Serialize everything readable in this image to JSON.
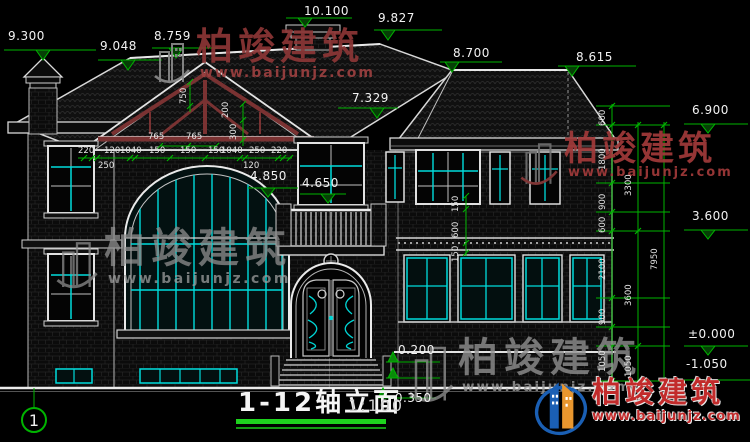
{
  "drawing": {
    "title": "1-12轴立面",
    "scale": "1:100",
    "axis_label": "1",
    "watermark": {
      "brand": "柏竣建筑",
      "url": "www.baijunjz.com"
    },
    "elevations": {
      "chimney_left": "9.300",
      "roof_left": "9.048",
      "gable_peak": "8.759",
      "roof_chimney_top": "10.100",
      "ridge": "9.827",
      "deck_left": "8.700",
      "deck_right": "8.615",
      "eave_right": "7.329",
      "level_eave": "6.900",
      "gable_window_head": "4.850",
      "balcony_rail": "4.650",
      "level_floor2": "3.600",
      "level_zero": "±0.000",
      "level_foundation": "-1.050",
      "entry_landing": "0.200",
      "entry_ground": "-0.350"
    },
    "dims": {
      "gable_width_row": [
        "765",
        "765"
      ],
      "facade_row": [
        "220",
        "120",
        "1040",
        "150",
        "150",
        "150",
        "1040",
        "250",
        "220"
      ],
      "facade_row2": [
        "250",
        "120"
      ],
      "truss": [
        "750",
        "200",
        "300"
      ],
      "cornice": [
        "150",
        "600",
        "150"
      ],
      "right_inner": [
        "600",
        "1800",
        "900",
        "600",
        "2100",
        "900",
        "1050"
      ],
      "right_mid": [
        "3300",
        "3600",
        "1050"
      ],
      "right_total": "7950"
    }
  }
}
